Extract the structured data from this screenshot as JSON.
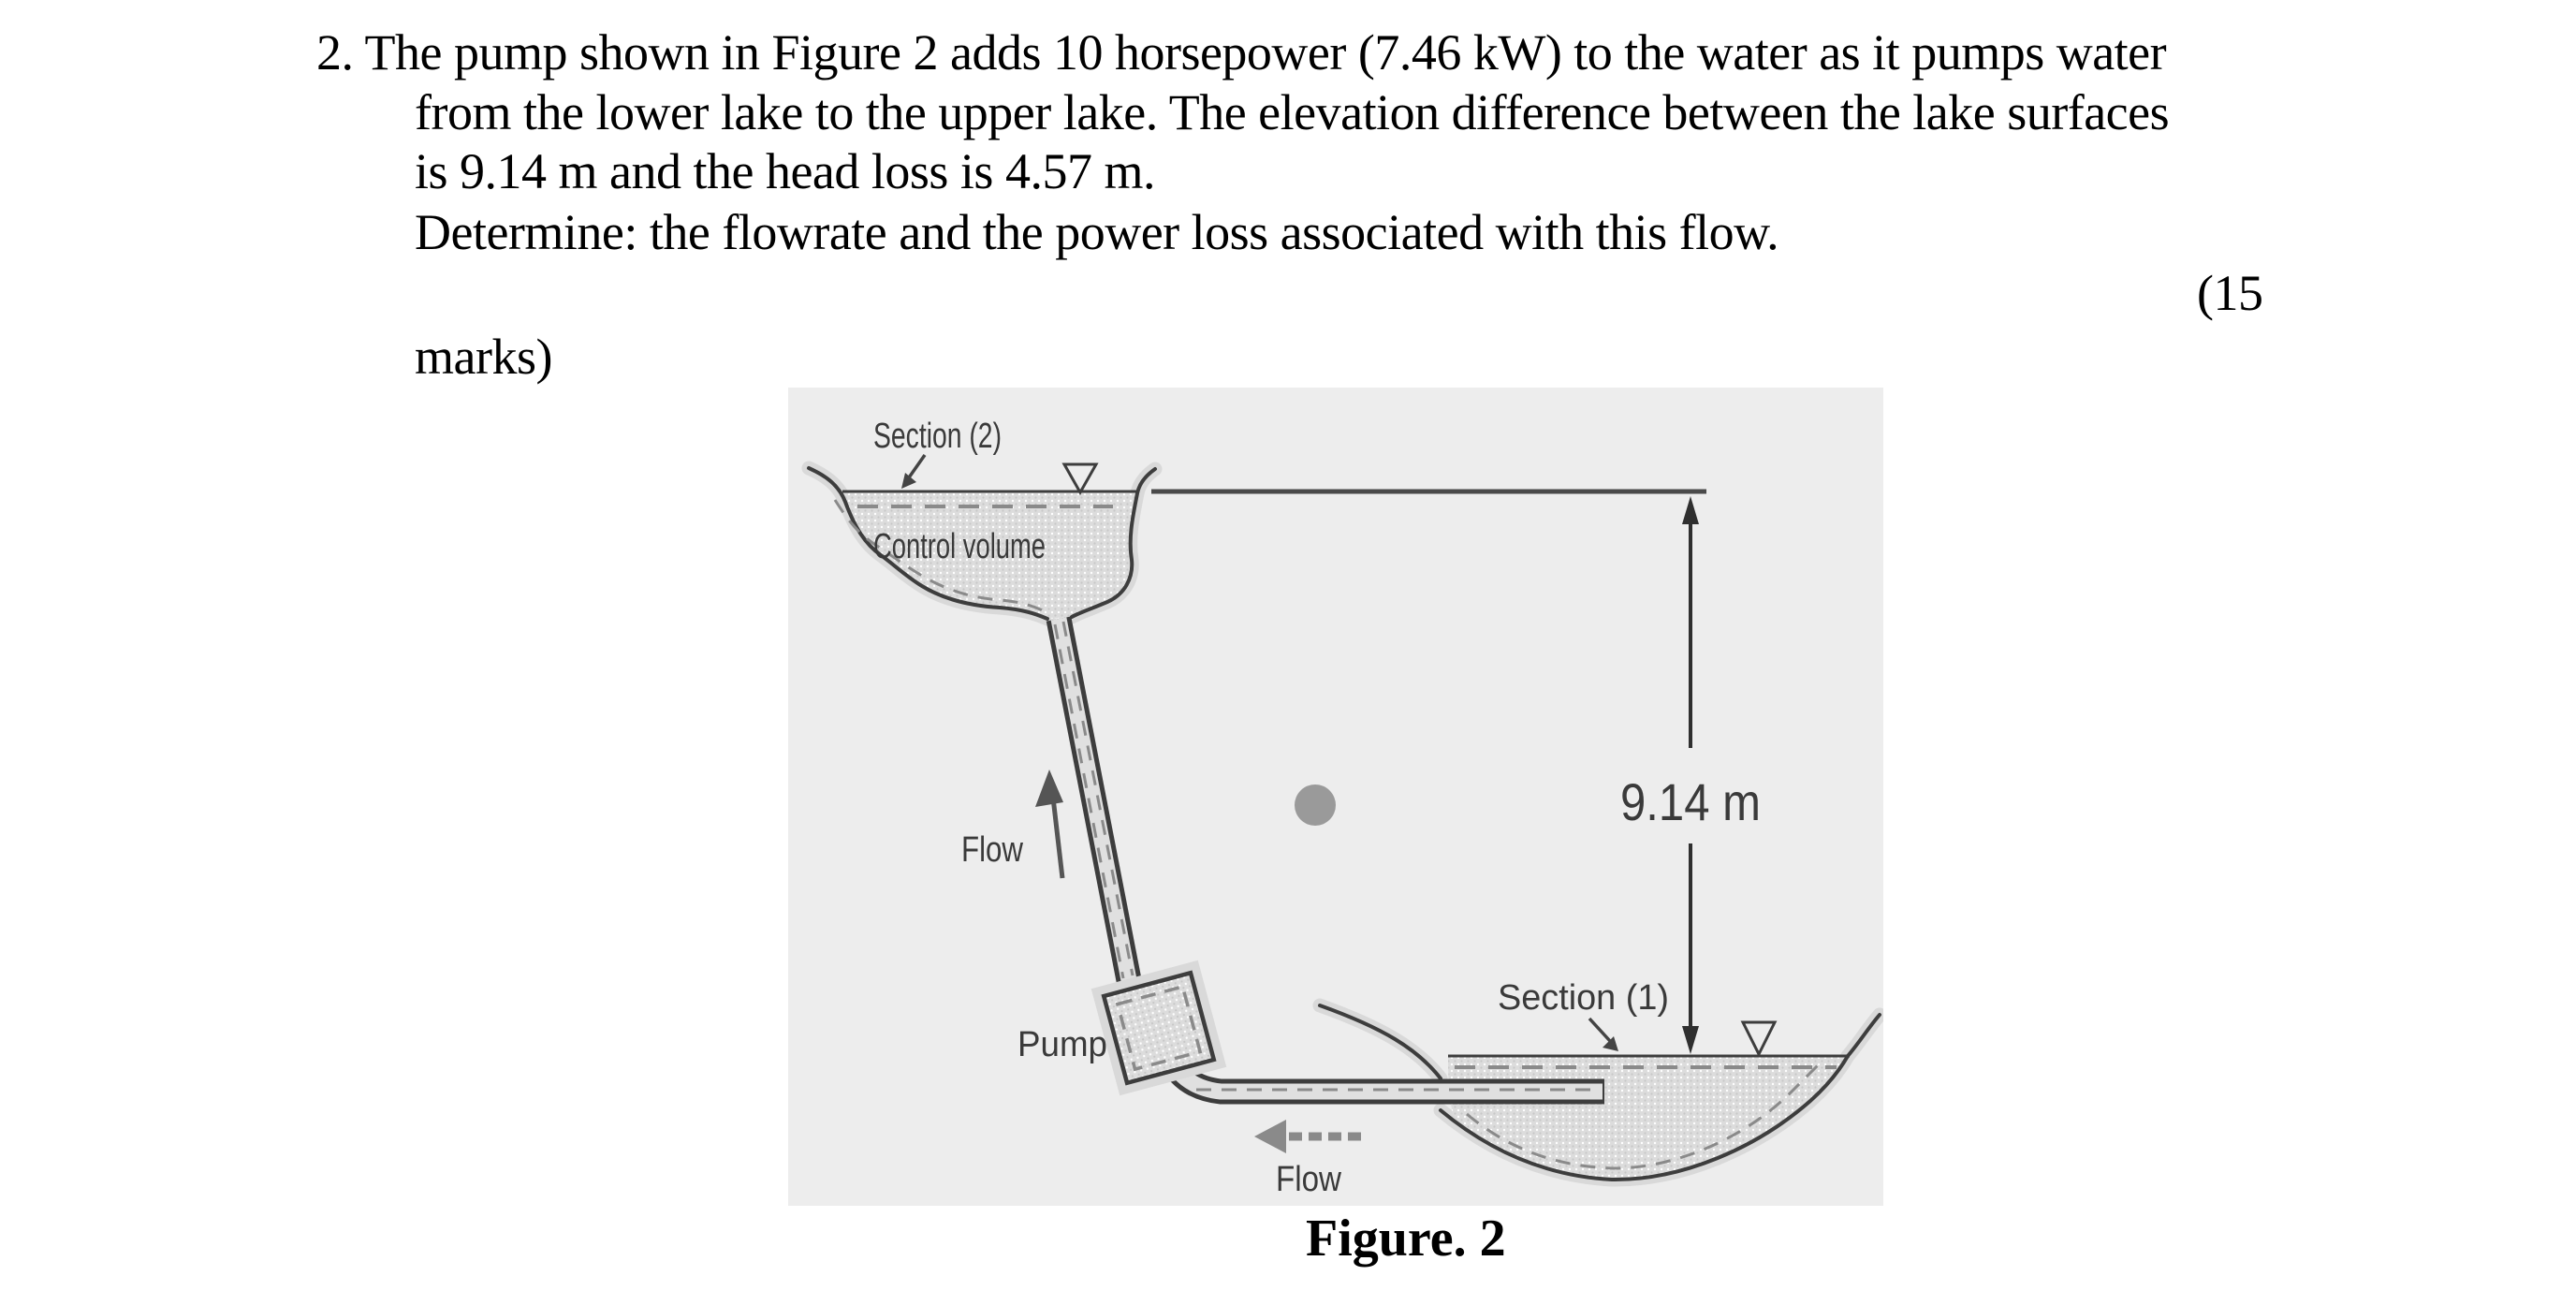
{
  "problem": {
    "lines": [
      "2. The pump shown in Figure 2 adds 10 horsepower (7.46 kW) to the water as it pumps water",
      "from the lower lake to the upper lake. The elevation difference between the lake surfaces",
      "is 9.14 m and the head loss is 4.57 m.",
      "Determine: the flowrate and the power loss associated with this flow.",
      "(15",
      "marks)"
    ]
  },
  "figure": {
    "caption": "Figure. 2",
    "labels": {
      "upper_section": "Section (2)",
      "control_volume": "Control volume",
      "upper_flow": "Flow",
      "pump": "Pump",
      "lower_section": "Section (1)",
      "lower_flow": "Flow",
      "elevation": "9.14 m"
    },
    "colors": {
      "figure_background": "#ededed",
      "water_fill": "#dcdcdc",
      "outline": "#3d3d3d",
      "dashed_boundary": "#8a8a8a",
      "gray_dot": "#9a9a9a",
      "label_text": "#3a3a3a"
    }
  }
}
